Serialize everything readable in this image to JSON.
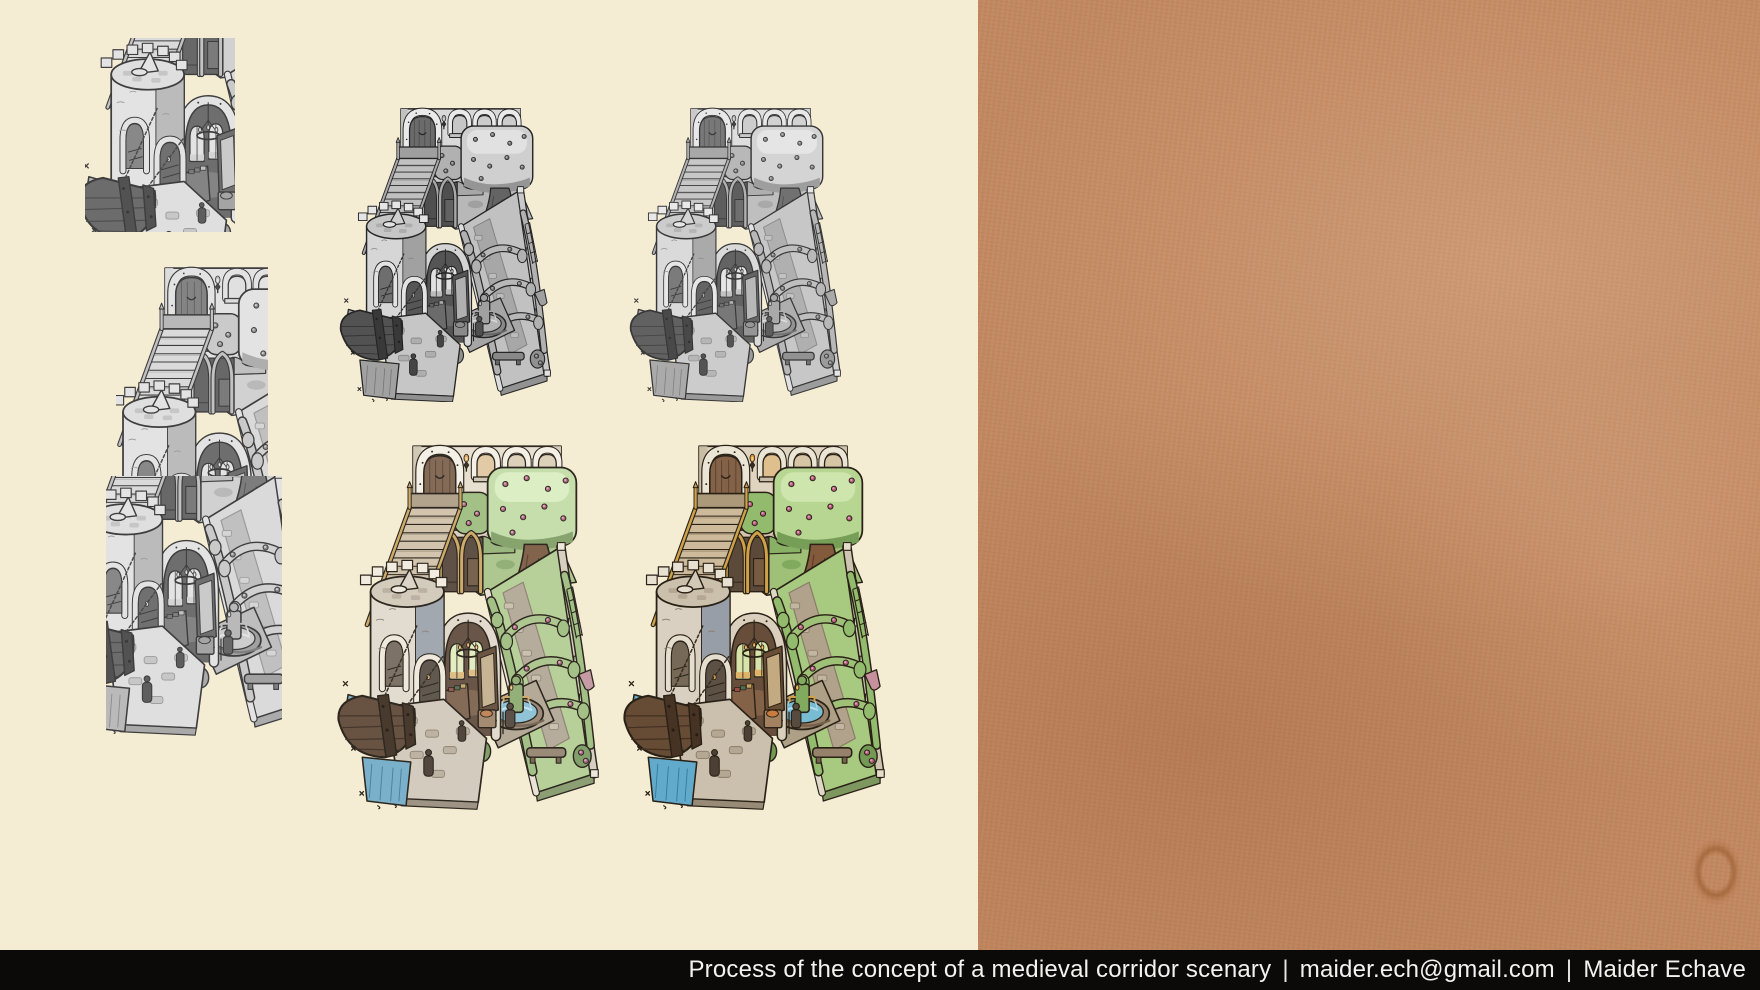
{
  "caption": {
    "process_text": "Process of the concept of a medieval corridor scenary",
    "separator": "|",
    "email": "maider.ech@gmail.com",
    "author": "Maider Echave"
  },
  "colors": {
    "left_panel_bg": "#f5ecd4",
    "right_panel_bg": "#c1875f",
    "caption_bar_bg": "#0b0a08",
    "caption_text": "#f4f2ee",
    "ink_outline": "#2b2114",
    "gold_accent": "#d7a23b",
    "foliage_green": "#a6cd77",
    "rose_pink": "#c2567f",
    "water_blue": "#58aed2",
    "wood_brown": "#6b4b31",
    "stone_tan": "#e3d6bd"
  }
}
